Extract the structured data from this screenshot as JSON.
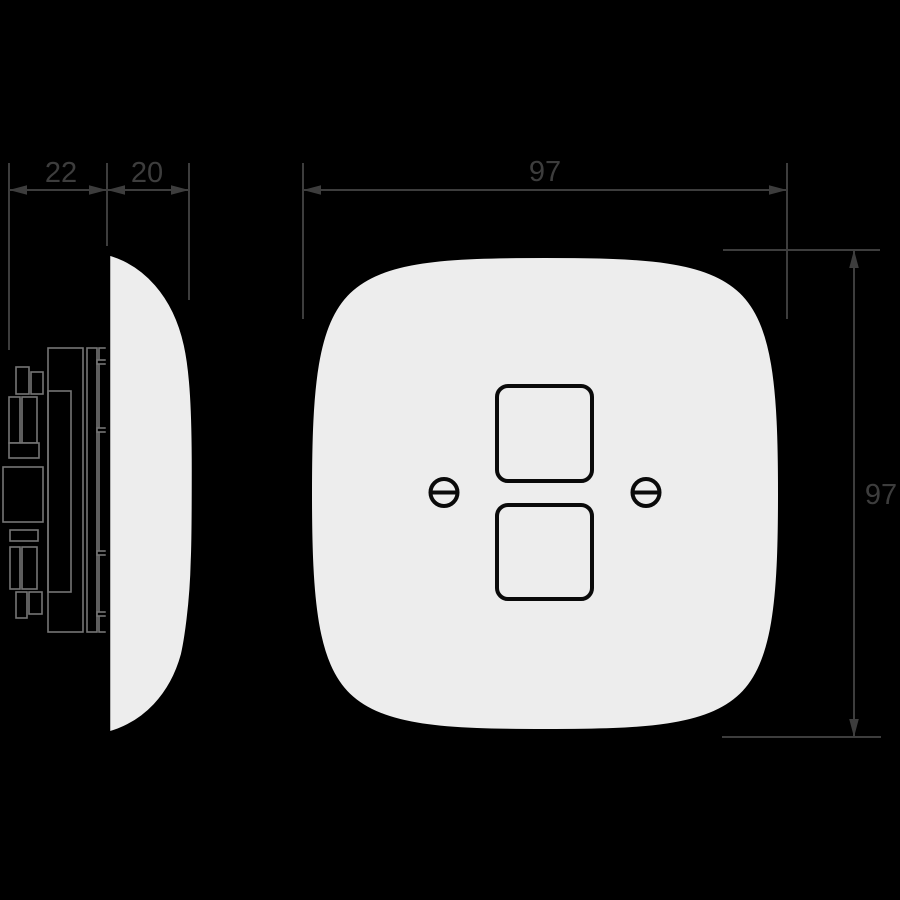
{
  "dimensions": {
    "mechanism_depth": "22",
    "plate_depth": "20",
    "plate_width": "97",
    "plate_height": "97"
  },
  "colors": {
    "background": "#000000",
    "dimension_lines": "#3d3d3d",
    "dimension_text": "#3d3d3d",
    "plate_fill": "#ededed",
    "plate_outline": "#000000",
    "mechanism_lines": "#757575"
  }
}
